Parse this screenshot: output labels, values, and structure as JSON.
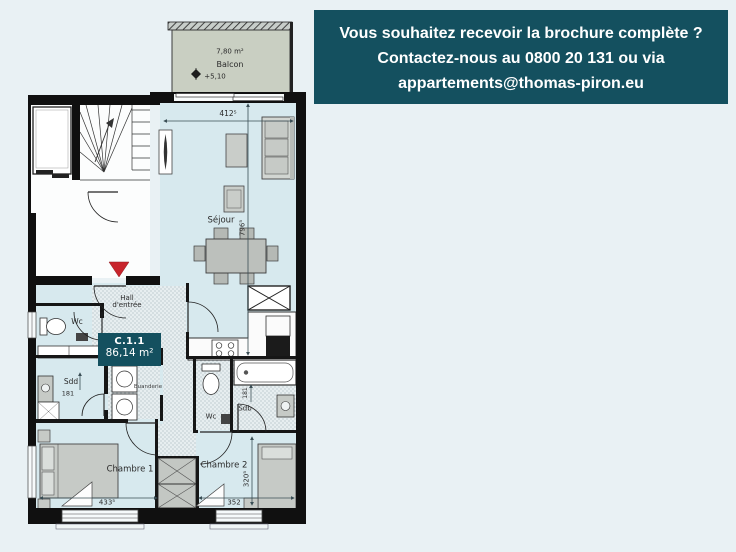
{
  "banner": {
    "bg_color": "#14505f",
    "text_color": "#ffffff",
    "lines": [
      "Vous souhaitez recevoir la brochure complète ?",
      "Contactez-nous au 0800 20 131 ou via",
      "appartements@thomas-piron.eu"
    ]
  },
  "floorplan": {
    "unit_badge": {
      "code": "C.1.1",
      "area": "86,14 m²",
      "bg_color": "#14505f"
    },
    "balcony": {
      "area": "7,80 m²",
      "name": "Balcon",
      "level": "+5,10",
      "fill_color": "#c9cfc2"
    },
    "rooms": {
      "sejour": "Séjour",
      "hall": "Hall d'entrée",
      "wc_top": "Wc",
      "shower_room": "Sdd",
      "laundry": "Buanderie",
      "wc_mid": "Wc",
      "bathroom": "Sdb",
      "bedroom1": "Chambre 1",
      "bedroom2": "Chambre 2"
    },
    "dimensions": {
      "sejour_width": "412⁵",
      "sejour_depth": "796⁵",
      "shower_width": "181",
      "bathroom_width": "181",
      "bedroom1_width": "433⁵",
      "bedroom2_width": "352",
      "bedroom2_depth": "320⁵"
    },
    "colors": {
      "room_fill": "#d7e9ee",
      "entrance_marker": "#c8242c",
      "wall": "#101010",
      "page_background": "#e9f1f4"
    }
  }
}
